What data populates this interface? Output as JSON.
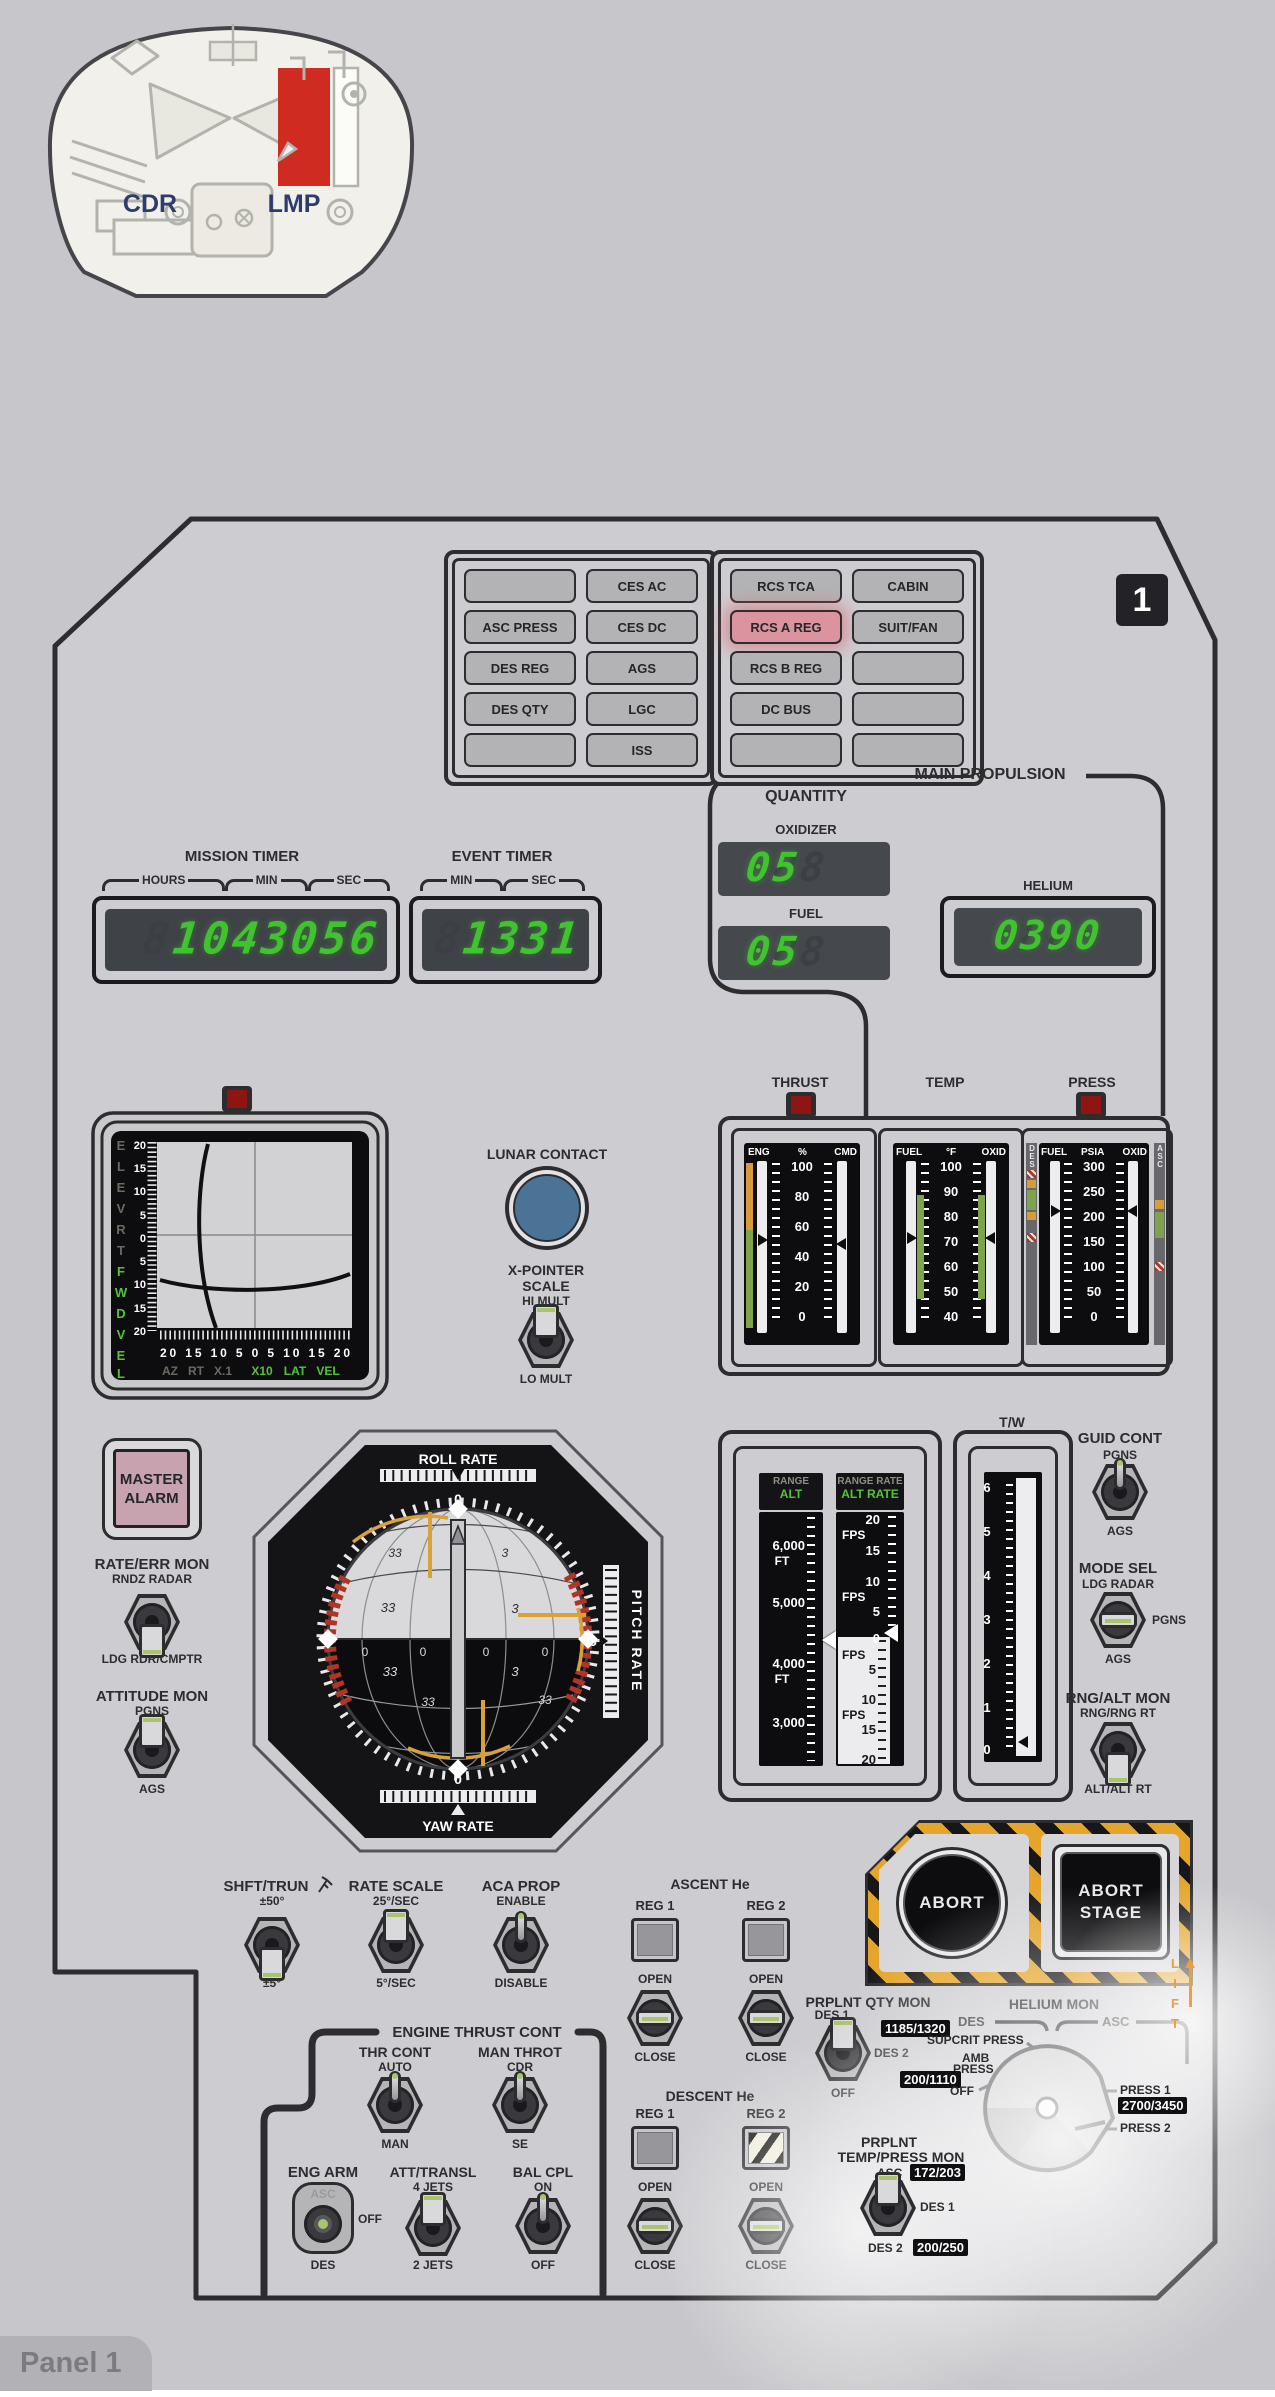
{
  "locator": {
    "cdr": "CDR",
    "lmp": "LMP"
  },
  "badge": "1",
  "tab": "Panel 1",
  "warning": {
    "cells": [
      "",
      "CES AC",
      "ASC PRESS",
      "CES DC",
      "DES REG",
      "AGS",
      "DES QTY",
      "LGC",
      "",
      "ISS"
    ]
  },
  "caution": {
    "cells": [
      "RCS TCA",
      "CABIN",
      "RCS A REG",
      "SUIT/FAN",
      "RCS B REG",
      "",
      "DC BUS",
      "",
      "",
      ""
    ]
  },
  "timers": {
    "mission": {
      "title": "MISSION TIMER",
      "u1": "HOURS",
      "u2": "MIN",
      "u3": "SEC",
      "value": "1043056",
      "ghost": "88888888"
    },
    "event": {
      "title": "EVENT TIMER",
      "u1": "MIN",
      "u2": "SEC",
      "value": "1331",
      "ghost": "88888"
    }
  },
  "mainprop": {
    "title": "MAIN PROPULSION",
    "quantity": "QUANTITY",
    "oxidizer": "OXIDIZER",
    "oxid_value": "05",
    "fuel": "FUEL",
    "fuel_value": "05",
    "helium": "HELIUM",
    "helium_value": "0390",
    "ghost2": "888",
    "ghost4": "8888"
  },
  "gauges": {
    "thrust": {
      "title": "THRUST",
      "c1": "ENG",
      "c2": "%",
      "c3": "CMD",
      "t": [
        "100",
        "80",
        "60",
        "40",
        "20",
        "0"
      ]
    },
    "temp": {
      "title": "TEMP",
      "c1": "FUEL",
      "c2": "°F",
      "c3": "OXID",
      "t": [
        "100",
        "90",
        "80",
        "70",
        "60",
        "50",
        "40"
      ]
    },
    "press": {
      "title": "PRESS",
      "c1": "FUEL",
      "c2": "PSIA",
      "c3": "OXID",
      "t": [
        "300",
        "250",
        "200",
        "150",
        "100",
        "50",
        "0"
      ],
      "left": "DES",
      "right": "ASC"
    }
  },
  "xpointer": {
    "dim_letters": [
      "E",
      "L",
      "E",
      "V",
      "R",
      "T"
    ],
    "lit_letters": [
      "F",
      "W",
      "D",
      "V",
      "E",
      "L"
    ],
    "scale": [
      "20",
      "15",
      "10",
      "5",
      "0",
      "5",
      "10",
      "15",
      "20"
    ],
    "row": "20 15 10 5 0 5 10 15 20",
    "dim_row": [
      "AZ",
      "RT",
      "X.1"
    ],
    "lit_row": [
      "X10",
      "LAT",
      "VEL"
    ]
  },
  "lunar_contact": "LUNAR CONTACT",
  "xp_scale": {
    "t1": "X-POINTER",
    "t2": "SCALE",
    "up": "HI MULT",
    "down": "LO MULT"
  },
  "master_alarm": {
    "l1": "MASTER",
    "l2": "ALARM"
  },
  "rate_err": {
    "title": "RATE/ERR MON",
    "up": "RNDZ RADAR",
    "down": "LDG RDR/CMPTR"
  },
  "att_mon": {
    "title": "ATTITUDE MON",
    "up": "PGNS",
    "down": "AGS"
  },
  "fdai": {
    "roll": "ROLL RATE",
    "pitch": "PITCH RATE",
    "yaw": "YAW RATE",
    "z1": "0",
    "z2": "0",
    "z3": "0",
    "n": [
      "33",
      "3",
      "33",
      "3",
      "0",
      "0",
      "0",
      "0",
      "33",
      "3",
      "33",
      "33"
    ]
  },
  "tapes": {
    "h1a": "RANGE",
    "h1b": "ALT",
    "h2a": "RANGE RATE",
    "h2b": "ALT RATE",
    "alt": [
      "6,000",
      "FT",
      "5,000",
      "4,000",
      "FT",
      "3,000"
    ],
    "rate": [
      "20",
      "FPS",
      "15",
      "10",
      "FPS",
      "5",
      "0",
      "FPS",
      "5",
      "10",
      "FPS",
      "15",
      "20"
    ]
  },
  "tw": {
    "title": "T/W",
    "t": [
      "6",
      "5",
      "4",
      "3",
      "2",
      "1",
      "0"
    ]
  },
  "guid_cont": {
    "title": "GUID CONT",
    "up": "PGNS",
    "down": "AGS"
  },
  "mode_sel": {
    "title": "MODE SEL",
    "up": "LDG RADAR",
    "mid": "PGNS",
    "down": "AGS"
  },
  "rng_alt": {
    "title": "RNG/ALT MON",
    "up": "RNG/RNG RT",
    "down": "ALT/ALT RT"
  },
  "shft": {
    "title": "SHFT/TRUN",
    "up": "±50°",
    "down": "±5°"
  },
  "rate_scale": {
    "title": "RATE SCALE",
    "up": "25°/SEC",
    "down": "5°/SEC"
  },
  "aca": {
    "title": "ACA PROP",
    "up": "ENABLE",
    "down": "DISABLE"
  },
  "etc": {
    "title": "ENGINE THRUST CONT"
  },
  "thr": {
    "title": "THR CONT",
    "up": "AUTO",
    "down": "MAN"
  },
  "man_throt": {
    "title": "MAN THROT",
    "up": "CDR",
    "down": "SE"
  },
  "eng_arm": {
    "title": "ENG ARM",
    "up": "ASC",
    "mid": "OFF",
    "down": "DES"
  },
  "att_transl": {
    "title": "ATT/TRANSL",
    "up": "4 JETS",
    "down": "2 JETS"
  },
  "bal": {
    "title": "BAL CPL",
    "up": "ON",
    "down": "OFF"
  },
  "asc_he": {
    "title": "ASCENT He",
    "r1": "REG 1",
    "r2": "REG 2",
    "open": "OPEN",
    "close": "CLOSE"
  },
  "des_he": {
    "title": "DESCENT He",
    "r1": "REG 1",
    "r2": "REG 2",
    "open": "OPEN",
    "close": "CLOSE"
  },
  "abort": {
    "b1": "ABORT",
    "b2a": "ABORT",
    "b2b": "STAGE",
    "lift": [
      "L",
      "I",
      "F",
      "T"
    ]
  },
  "qty_mon": {
    "title": "PRPLNT QTY MON",
    "up": "DES 1",
    "right": "DES 2",
    "down": "OFF"
  },
  "helium_mon": {
    "title": "HELIUM MON",
    "des": "DES",
    "asc": "ASC",
    "supcrit": "SUPCRIT PRESS",
    "amb1": "AMB",
    "amb2": "PRESS",
    "off": "OFF",
    "p1": "PRESS 1",
    "p2": "PRESS 2",
    "b_sup": "1185/1320",
    "b_amb": "200/1110",
    "b_p1": "2700/3450"
  },
  "temp_mon": {
    "t1": "PRPLNT",
    "t2": "TEMP/PRESS MON",
    "asc": "ASC",
    "b_asc": "172/203",
    "d1": "DES 1",
    "d2": "DES 2",
    "b_d2": "200/250"
  },
  "colors": {
    "lit_green": "#3fc32e",
    "hazard_orange": "#e4a52a",
    "warn_red": "#b23426",
    "band_green": "#7fa24c",
    "band_orange": "#d99b3a",
    "lunar_blue": "#4a7396",
    "alarm_pink": "#c6a3af",
    "lit_pink": "#db93a0"
  }
}
